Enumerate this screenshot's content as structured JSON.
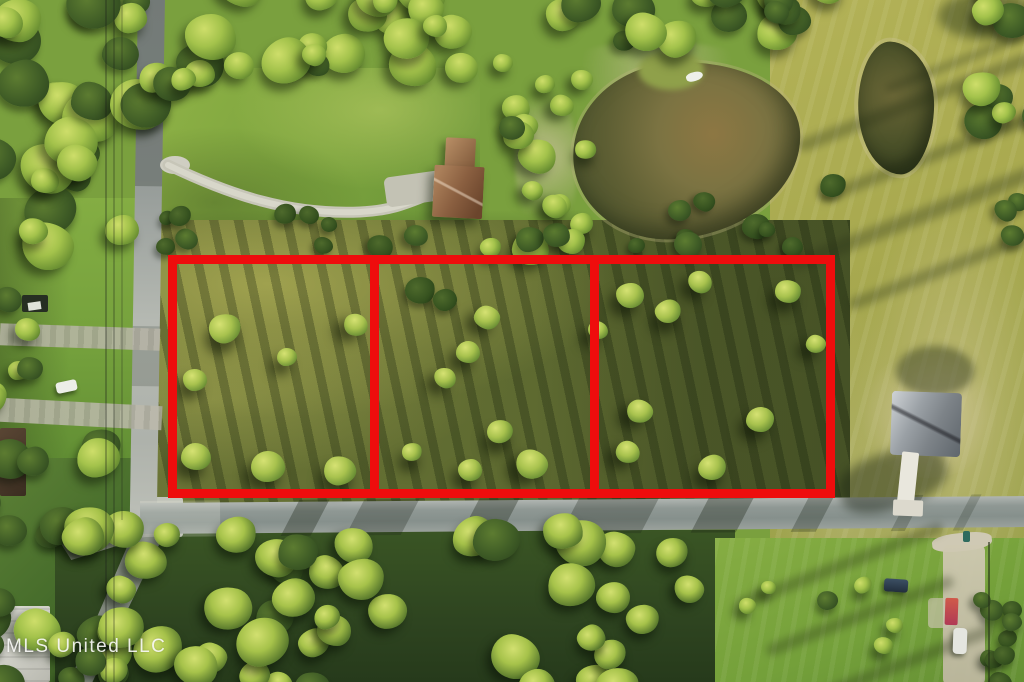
{
  "image_type": "aerial-drone-photo-of-vacant-land-listing",
  "watermark": {
    "text": "MLS United LLC"
  },
  "boundary_overlay": {
    "color": "#ee0d0d",
    "parcel_count": 3,
    "parcels": [
      {
        "name": "parcel-1"
      },
      {
        "name": "parcel-2"
      },
      {
        "name": "parcel-3"
      }
    ]
  },
  "scene": {
    "features": [
      "left-road",
      "bottom-road",
      "branch-road",
      "curved-gravel-driveway",
      "farm-house-brown-roof",
      "large-pond",
      "small-pond",
      "boat-dock",
      "gray-roof-house",
      "white-walkway",
      "sand-patches",
      "tree-canopy",
      "open-mowed-field",
      "lawn",
      "white-car",
      "utility-trailer",
      "dark-truck",
      "white-car-right",
      "red-object",
      "trash-bin",
      "power-lines",
      "hedge-fence-line"
    ]
  },
  "palette": {
    "boundary_red": "#ee0d0d",
    "canopy_dark": "#2e4420",
    "tree_bright": "#9fc24a",
    "grass_lawn": "#82aa42",
    "field_yellow": "#aaa94f",
    "scrub_olive": "#65702f",
    "asphalt": "#8f9894",
    "gravel": "#c6c4b6",
    "water_murky": "#72693c",
    "sand": "#cbc49b",
    "watermark_white": "#f5f5f3"
  }
}
